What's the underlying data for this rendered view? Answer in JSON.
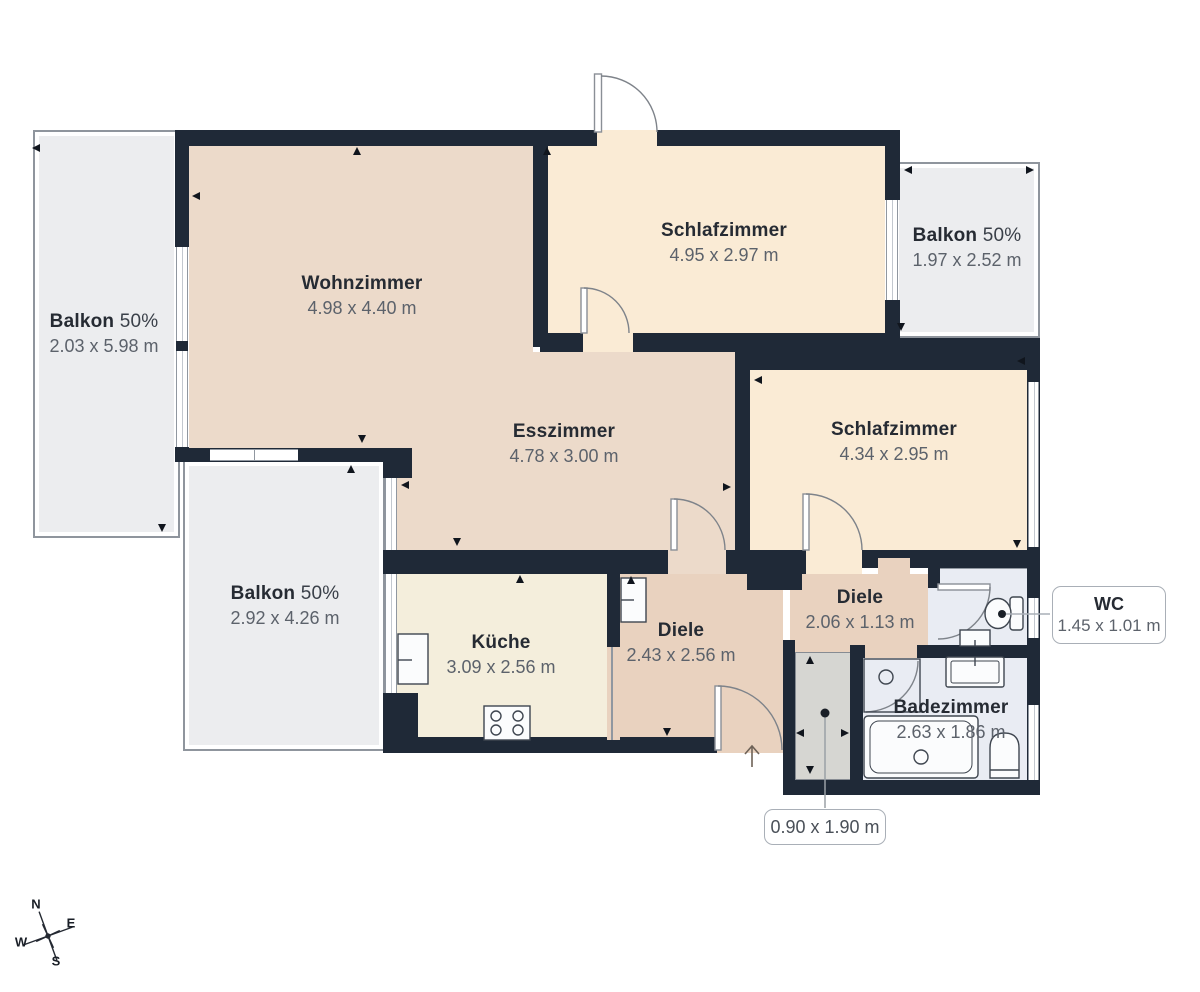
{
  "plan": {
    "rooms": [
      {
        "id": "wohnzimmer",
        "name": "Wohnzimmer",
        "dims": "4.98 x 4.40 m"
      },
      {
        "id": "schlafzimmer-1",
        "name": "Schlafzimmer",
        "dims": "4.95 x 2.97 m"
      },
      {
        "id": "esszimmer",
        "name": "Esszimmer",
        "dims": "4.78 x 3.00 m"
      },
      {
        "id": "schlafzimmer-2",
        "name": "Schlafzimmer",
        "dims": "4.34 x 2.95 m"
      },
      {
        "id": "kueche",
        "name": "Küche",
        "dims": "3.09 x 2.56 m"
      },
      {
        "id": "diele-1",
        "name": "Diele",
        "dims": "2.43 x 2.56 m"
      },
      {
        "id": "diele-2",
        "name": "Diele",
        "dims": "2.06 x 1.13 m"
      },
      {
        "id": "badezimmer",
        "name": "Badezimmer",
        "dims": "2.63 x 1.86 m"
      }
    ],
    "balconies": [
      {
        "id": "balkon-left",
        "name": "Balkon",
        "share": "50%",
        "dims": "2.03 x 5.98 m"
      },
      {
        "id": "balkon-top-right",
        "name": "Balkon",
        "share": "50%",
        "dims": "1.97 x 2.52 m"
      },
      {
        "id": "balkon-bottom-left",
        "name": "Balkon",
        "share": "50%",
        "dims": "2.92 x 4.26 m"
      }
    ],
    "callouts": {
      "wc": {
        "name": "WC",
        "dims": "1.45 x 1.01 m"
      },
      "entrance_niche": {
        "dims": "0.90 x 1.90 m"
      }
    },
    "compass": {
      "north": "N",
      "east": "E",
      "south": "S",
      "west": "W"
    },
    "colors": {
      "wall": "#1F2937",
      "living": "#ECDACA",
      "bedroom": "#FAEBD5",
      "kitchen": "#F4EEDC",
      "hallway": "#E9D2BF",
      "bathroom": "#E9ECF3",
      "balcony": "#ECEDEF",
      "niche": "#D6D6D2"
    }
  }
}
